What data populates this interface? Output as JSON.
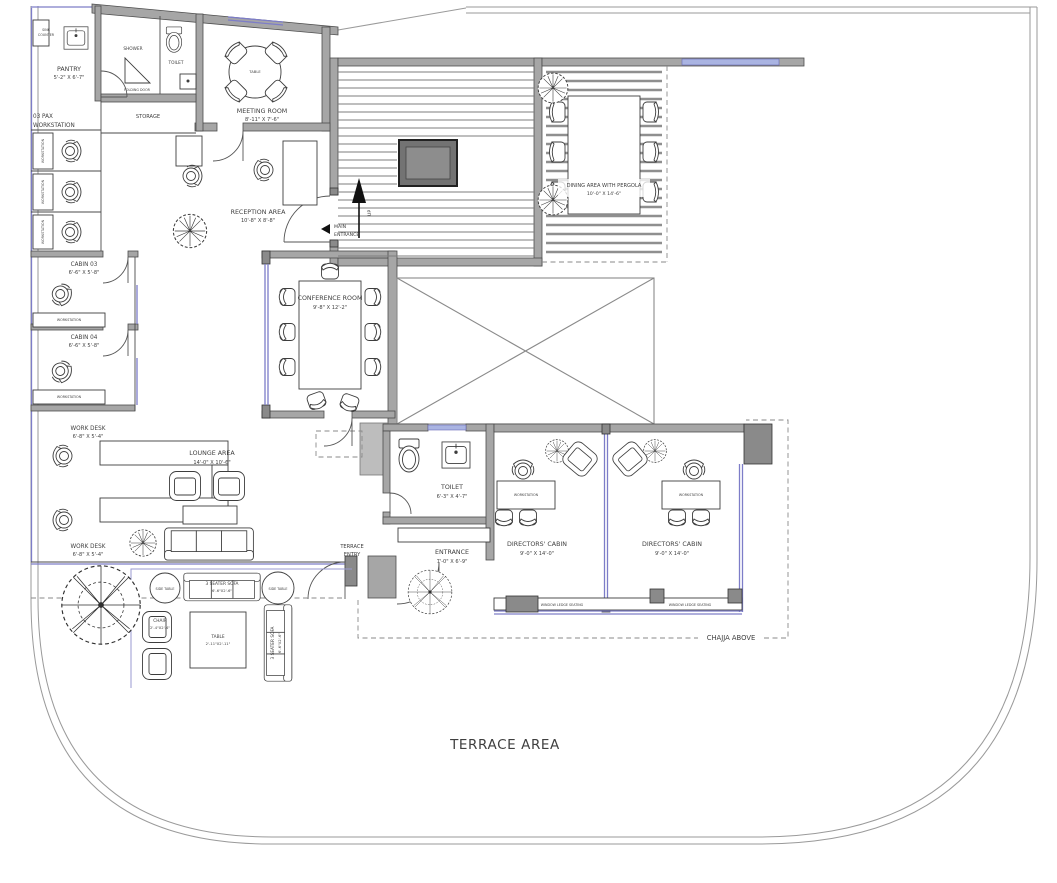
{
  "labels": {
    "terrace_area": "TERRACE AREA",
    "chajja_above": "CHAJJA ABOVE",
    "up": "UP",
    "main_entrance_1": "MAIN",
    "main_entrance_2": "ENTRANCE",
    "terrace_entry_1": "TERRACE",
    "terrace_entry_2": "ENTRY",
    "storage": "STORAGE",
    "shower": "SHOWER",
    "toilet_small": "TOILET",
    "folding_door": "FOLDING DOOR",
    "workstation": "WORKSTATION",
    "window_ledge_seating": "WINDOW LEDGE SEATING",
    "side_table": "SIDE TABLE",
    "table_small": "TABLE",
    "pax_1": "03 PAX",
    "pax_2": "WORKSTATION",
    "counter_1": "SINK",
    "counter_2": "COUNTER"
  },
  "rooms": {
    "pantry": {
      "name": "PANTRY",
      "dims": "5'-2\" X 6'-7\""
    },
    "meeting": {
      "name": "MEETING ROOM",
      "dims": "8'-11\" X 7'-6\""
    },
    "reception": {
      "name": "RECEPTION AREA",
      "dims": "10'-8\" X 8'-8\""
    },
    "dining": {
      "name": "DINING AREA WITH PERGOLA",
      "dims": "10'-0\" X 14'-6\""
    },
    "conference": {
      "name": "CONFERENCE ROOM",
      "dims": "9'-8\" X 12'-2\""
    },
    "cabin3": {
      "name": "CABIN 03",
      "dims": "6'-6\" X 5'-8\""
    },
    "cabin4": {
      "name": "CABIN 04",
      "dims": "6'-6\" X 5'-8\""
    },
    "workdesk": {
      "name": "WORK DESK",
      "dims": "6'-8\" X 5'-4\""
    },
    "lounge": {
      "name": "LOUNGE AREA",
      "dims": "14'-0\" X 10'-6\""
    },
    "toilet": {
      "name": "TOILET",
      "dims": "6'-3\" X 4'-7\""
    },
    "entrance": {
      "name": "ENTRANCE",
      "dims": "7'-0\" X 6'-9\""
    },
    "directors": {
      "name": "DIRECTORS' CABIN",
      "dims": "9'-0\" X 14'-0\""
    }
  },
  "furniture": {
    "sofa3": {
      "name": "3 SEATER SOFA",
      "dims": "6'-6\"X2'-6\""
    },
    "chair": {
      "name": "CHAIR",
      "dims": "2'-4\"X2'-4\""
    },
    "table": {
      "name": "TABLE",
      "dims": "2'-11\"X2'-11\""
    }
  },
  "colors": {
    "wall": "#a6a6a6",
    "column": "#8a8a8a",
    "glass_blue": "#7d7dc8",
    "line": "#4a4a4a"
  }
}
